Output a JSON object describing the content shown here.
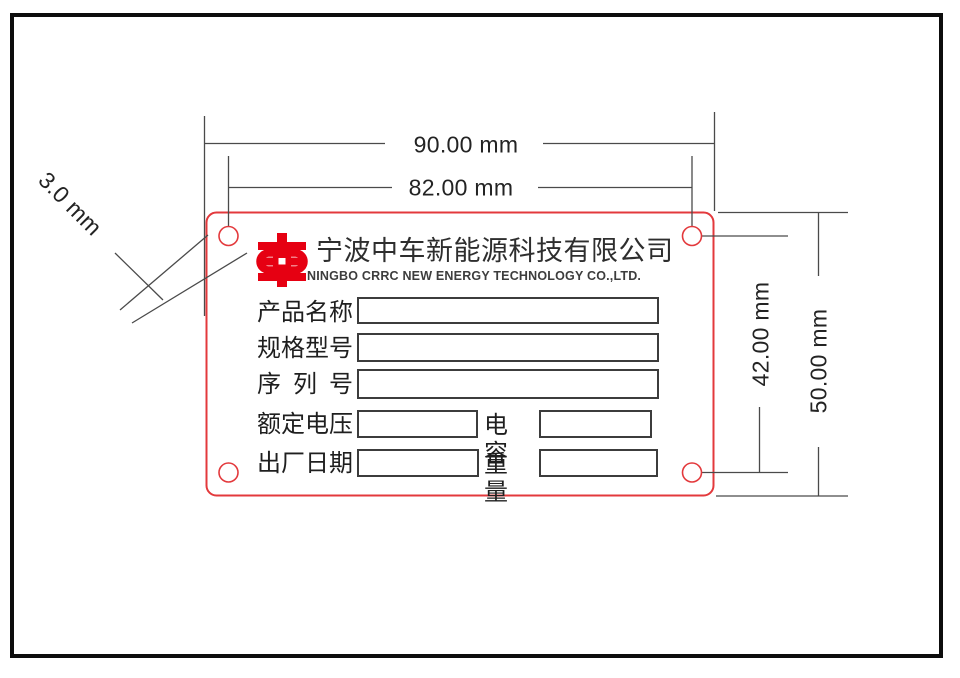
{
  "dimensions": {
    "outer_width": "90.00 mm",
    "hole_span_width": "82.00 mm",
    "hole_span_height": "42.00 mm",
    "outer_height": "50.00 mm",
    "hole_diameter": "3.0 mm"
  },
  "plate": {
    "company_name_cn": "宁波中车新能源科技有限公司",
    "company_name_en": "NINGBO CRRC NEW ENERGY TECHNOLOGY CO.,LTD.",
    "fields": {
      "product_name": "产品名称",
      "spec_model": "规格型号",
      "serial_no": "序 列 号",
      "rated_voltage": "额定电压",
      "capacitance": "电容",
      "manufacture_date": "出厂日期",
      "weight": "重量"
    }
  },
  "colors": {
    "plate_red": "#e3393c",
    "logo_red": "#e60012",
    "line_gray": "#4a4a4a"
  }
}
